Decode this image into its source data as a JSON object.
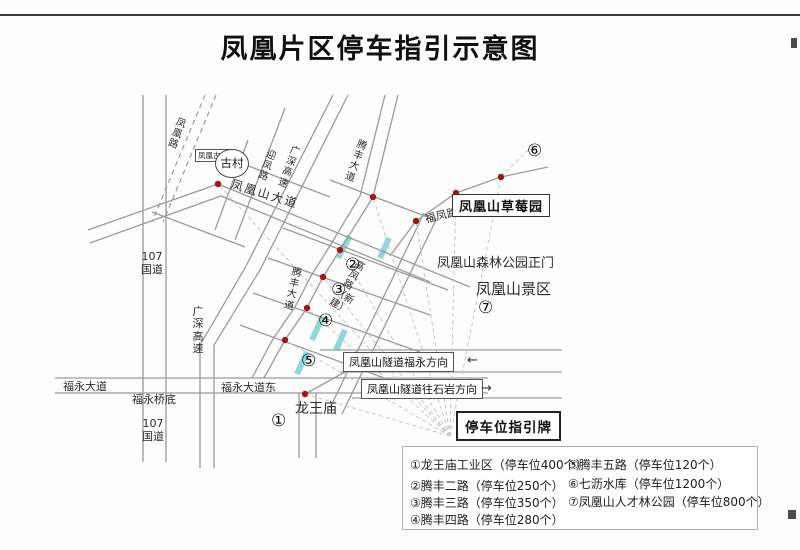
{
  "title": "凤凰片区停车指引示意图",
  "map": {
    "labels": {
      "fenghuang_road": "凤凰路",
      "gucun_box": "凤凰古村",
      "gucun_circle": "古村",
      "fenghuangshan_avenue": "凤凰山大道",
      "yingfeng_road": "迎凤路",
      "guangshen_expressway_diagonal": "广深高速",
      "tengfeng_avenue_north": "腾丰大道",
      "tengfeng_avenue_mid": "腾丰大道",
      "fufeng_road": "福凤路",
      "strawberry_garden": "凤凰山草莓园",
      "forest_park_gate": "凤凰山森林公园正门",
      "scenic_area": "凤凰山景区",
      "gaofeng_road": "高凤路（新建）",
      "tunnel_to_fuyong": "凤凰山隧道福永方向",
      "tunnel_to_shiyan": "凤凰山隧道往石岩方向",
      "arrow_left": "←",
      "arrow_right": "→",
      "longwang_temple": "龙王庙",
      "parking_sign": "停车位指引牌",
      "fuyong_avenue": "福永大道",
      "fuyong_avenue_east": "福永大道东",
      "fuyong_bridge": "福永桥底",
      "g107_north": "107国道",
      "g107_south": "107国道",
      "guangshen_expressway_vertical": "广深高速"
    },
    "markers": [
      "①",
      "②",
      "③",
      "④",
      "⑤",
      "⑥",
      "⑦"
    ]
  },
  "legend": {
    "items": [
      "①龙王庙工业区（停车位400个）",
      "②腾丰二路（停车位250个）",
      "③腾丰三路（停车位350个）",
      "④腾丰四路（停车位280个）",
      "⑤腾丰五路（停车位120个）",
      "⑥七沥水库（停车位1200个）",
      "⑦凤凰山人才林公园（停车位800个）"
    ]
  },
  "colors": {
    "road": "#9a9a9a",
    "dot": "#a51414",
    "highlight": "#8fd8d8",
    "dashed": "#c6c6c6"
  }
}
